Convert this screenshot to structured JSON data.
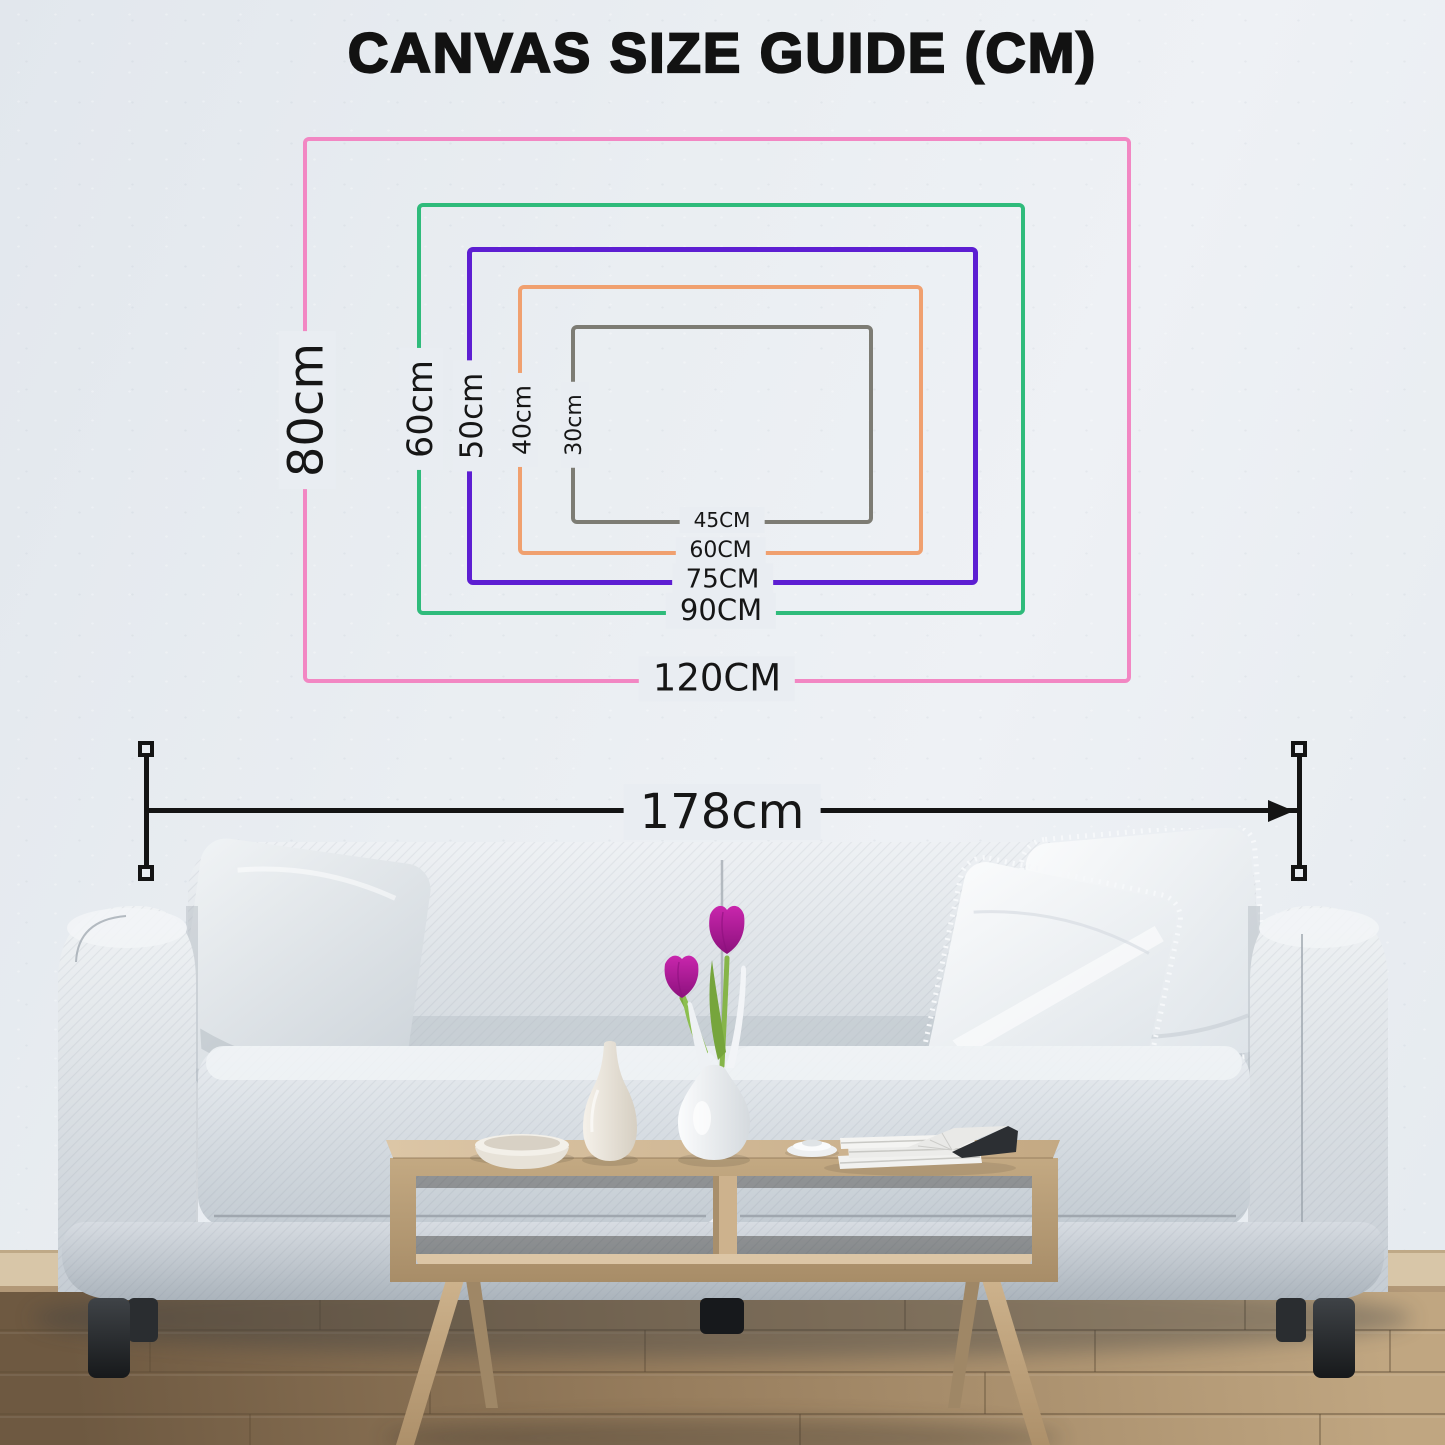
{
  "title": "CANVAS SIZE GUIDE (CM)",
  "sizes": [
    {
      "id": "120x80",
      "width_label": "120CM",
      "height_label": "80cm",
      "color": "#f287c3"
    },
    {
      "id": "90x60",
      "width_label": "90CM",
      "height_label": "60cm",
      "color": "#2fbb7b"
    },
    {
      "id": "75x50",
      "width_label": "75CM",
      "height_label": "50cm",
      "color": "#5d1ed2"
    },
    {
      "id": "60x40",
      "width_label": "60CM",
      "height_label": "40cm",
      "color": "#f0a06f"
    },
    {
      "id": "45x30",
      "width_label": "45CM",
      "height_label": "30cm",
      "color": "#7d7c74"
    }
  ],
  "measurement": {
    "label": "178cm",
    "color": "#141414"
  },
  "palette": {
    "wall": "#e9edf2",
    "text": "#161616",
    "sofa_fabric": "#dfe4e9",
    "pillow_white": "#f6f8fa",
    "wood": "#c8ad89",
    "floor": "#9a7f60",
    "tulip": "#b81d9c",
    "leaf": "#7fae46",
    "sofa_leg": "#26282b"
  },
  "scene": {
    "objects": [
      "sofa",
      "throw-pillows",
      "coffee-table",
      "decor-bowl",
      "bottle-vase",
      "tulip-vase",
      "pink-tulips",
      "magazine-stack",
      "small-plates",
      "wood-floor"
    ]
  }
}
